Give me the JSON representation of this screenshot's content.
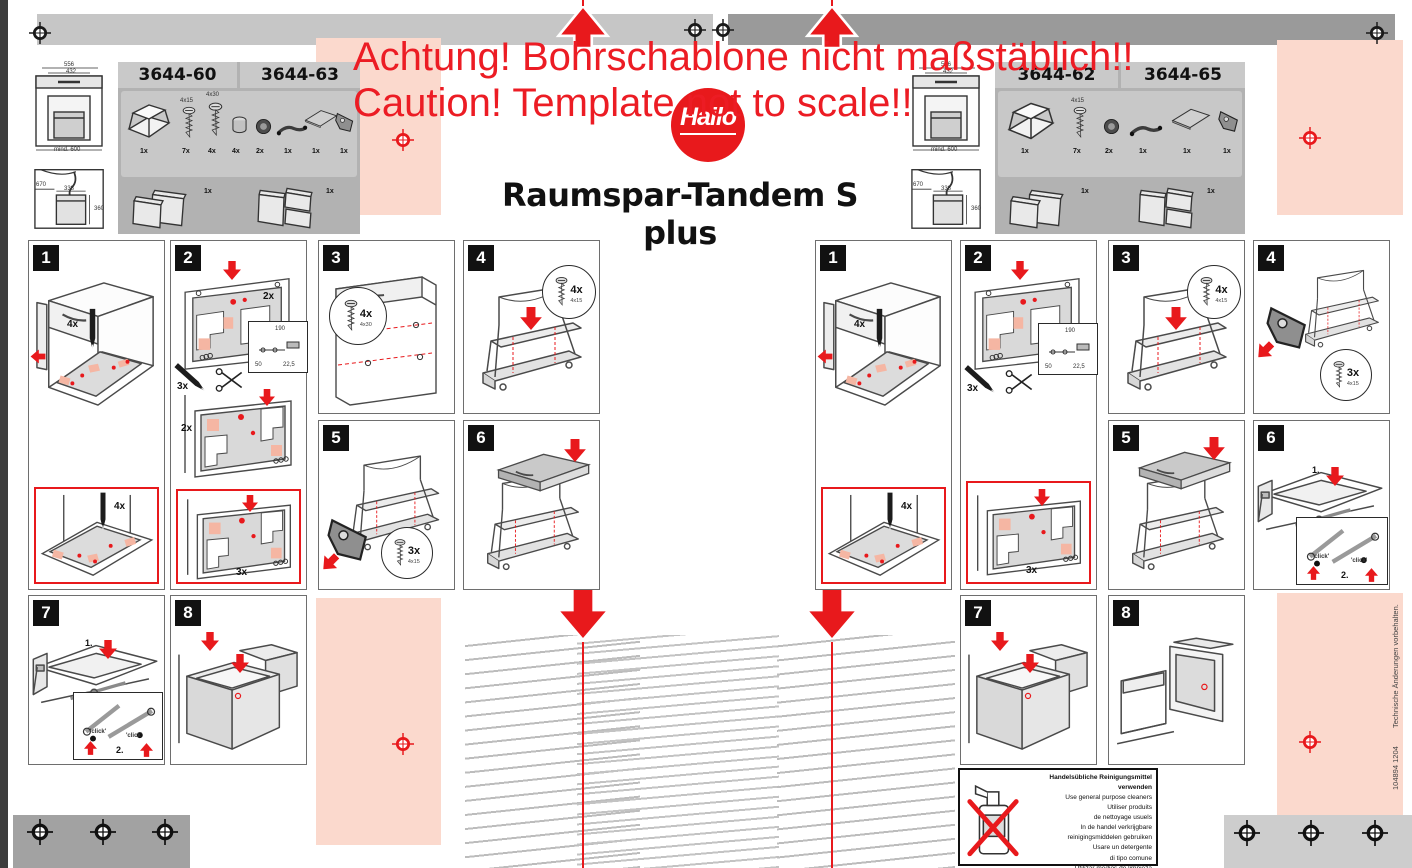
{
  "sheet": {
    "warning_line1": "Achtung! Bohrschablone nicht maßstäblich!!",
    "warning_line2": "Caution! Template not to scale!!",
    "brand": "Hailo",
    "title": "Raumspar-Tandem S plus",
    "doc_number": "104894 1204",
    "rights_note": "Technische Änderungen vorbehalten.",
    "colors": {
      "red": "#e8191c",
      "salmon": "#fbd9cd",
      "bar_light": "#c6c6c6",
      "bar_dark": "#9a9a9a"
    }
  },
  "products_left": {
    "model_a": "3644-60",
    "model_b": "3644-63",
    "dims": {
      "width": "556",
      "inner_width": "432",
      "min_depth": "mind. 600",
      "sink_depth": "670",
      "sink_inner": "338",
      "sink_height": "360"
    },
    "parts": [
      {
        "name": "pull-out-frame",
        "qty": "1x"
      },
      {
        "name": "screw",
        "size": "4x15",
        "qty": "7x"
      },
      {
        "name": "screw",
        "size": "4x30",
        "qty": "4x"
      },
      {
        "name": "cover-cap",
        "qty": "4x"
      },
      {
        "name": "fixing-disc",
        "qty": "2x"
      },
      {
        "name": "lever",
        "qty": "1x"
      },
      {
        "name": "lid-shelf",
        "qty": "1x"
      },
      {
        "name": "damper-bracket",
        "qty": "1x"
      }
    ],
    "bins": [
      {
        "name": "waste-bin-set-2",
        "qty": "1x"
      },
      {
        "name": "waste-bin-set-3",
        "qty": "1x"
      }
    ]
  },
  "products_right": {
    "model_a": "3644-62",
    "model_b": "3644-65",
    "dims": {
      "width": "556",
      "inner_width": "432",
      "min_depth": "mind. 600",
      "sink_depth": "670",
      "sink_inner": "338",
      "sink_height": "360"
    },
    "parts": [
      {
        "name": "pull-out-frame",
        "qty": "1x"
      },
      {
        "name": "screw",
        "size": "4x15",
        "qty": "7x"
      },
      {
        "name": "fixing-disc",
        "qty": "2x"
      },
      {
        "name": "lever",
        "qty": "1x"
      },
      {
        "name": "lid-shelf",
        "qty": "1x"
      },
      {
        "name": "damper-bracket",
        "qty": "1x"
      }
    ],
    "bins": [
      {
        "name": "waste-bin-set-2",
        "qty": "1x"
      },
      {
        "name": "waste-bin-set-3",
        "qty": "1x"
      }
    ]
  },
  "steps_left": [
    {
      "num": "1",
      "mark_qty": "4x",
      "detail_mark_qty": "4x"
    },
    {
      "num": "2",
      "template_qty": "2x",
      "cut_qty": "3x",
      "dim_a": "190",
      "dim_b": "50",
      "dim_c": "22,5",
      "mid_qty": "2x",
      "detail_qty": "3x"
    },
    {
      "num": "3",
      "screw_qty": "4x",
      "screw_size": "4x30"
    },
    {
      "num": "4",
      "screw_qty": "4x",
      "screw_size": "4x15"
    },
    {
      "num": "5",
      "screw_qty": "3x",
      "screw_size": "4x15"
    },
    {
      "num": "6"
    },
    {
      "num": "7",
      "order_a": "1.",
      "order_b": "2.",
      "click_a": "'click'",
      "click_b": "'click'"
    },
    {
      "num": "8"
    }
  ],
  "steps_right": [
    {
      "num": "1",
      "mark_qty": "4x",
      "detail_mark_qty": "4x"
    },
    {
      "num": "2",
      "cut_qty": "3x",
      "dim_a": "190",
      "dim_b": "50",
      "dim_c": "22,5",
      "detail_qty": "3x"
    },
    {
      "num": "3",
      "screw_qty": "4x",
      "screw_size": "4x15"
    },
    {
      "num": "4",
      "screw_qty": "3x",
      "screw_size": "4x15"
    },
    {
      "num": "5"
    },
    {
      "num": "6",
      "order_a": "1.",
      "order_b": "2.",
      "click_a": "'click'",
      "click_b": "'click'"
    },
    {
      "num": "7"
    },
    {
      "num": "8"
    }
  ],
  "cleaning": {
    "lines": [
      "Handelsübliche Reinigungsmittel verwenden",
      "Use general purpose cleaners",
      "Utiliser produits",
      "de nettoyage usuels",
      "In de handel verkrijgbare",
      "reinigingsmiddelen gebruiken",
      "Usare un detergente",
      "di tipo comune",
      "Utilizar medios de limpieza convencionales"
    ]
  }
}
